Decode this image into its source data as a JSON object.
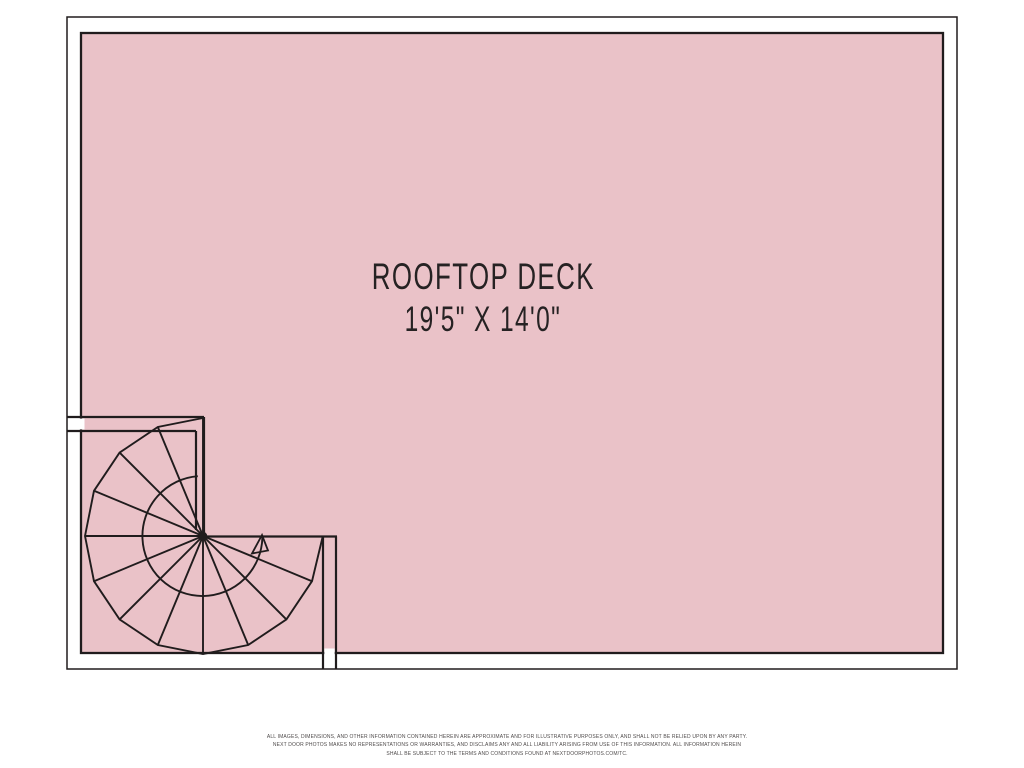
{
  "colors": {
    "background": "#ffffff",
    "deck_fill": "#eac2c8",
    "line": "#201c1d",
    "label_text": "#262223",
    "disclaimer_text": "#4f4b4b"
  },
  "floor_plan": {
    "room_label": "ROOFTOP DECK",
    "room_dimensions": "19'5\" X 14'0\"",
    "graphics": {
      "staircase": "spiral-staircase",
      "direction_indicator": "up-arrow-icon"
    }
  },
  "disclaimer": {
    "line1": "ALL IMAGES, DIMENSIONS, AND OTHER INFORMATION CONTAINED HEREIN ARE APPROXIMATE AND FOR ILLUSTRATIVE PURPOSES ONLY, AND SHALL NOT BE RELIED UPON BY ANY PARTY.",
    "line2": "NEXT DOOR PHOTOS MAKES NO REPRESENTATIONS OR WARRANTIES, AND DISCLAIMS ANY AND ALL LIABILITY ARISING FROM USE OF THIS INFORMATION. ALL INFORMATION HEREIN",
    "line3": "SHALL BE SUBJECT TO THE TERMS AND CONDITIONS FOUND AT NEXTDOORPHOTOS.COM/TC."
  }
}
